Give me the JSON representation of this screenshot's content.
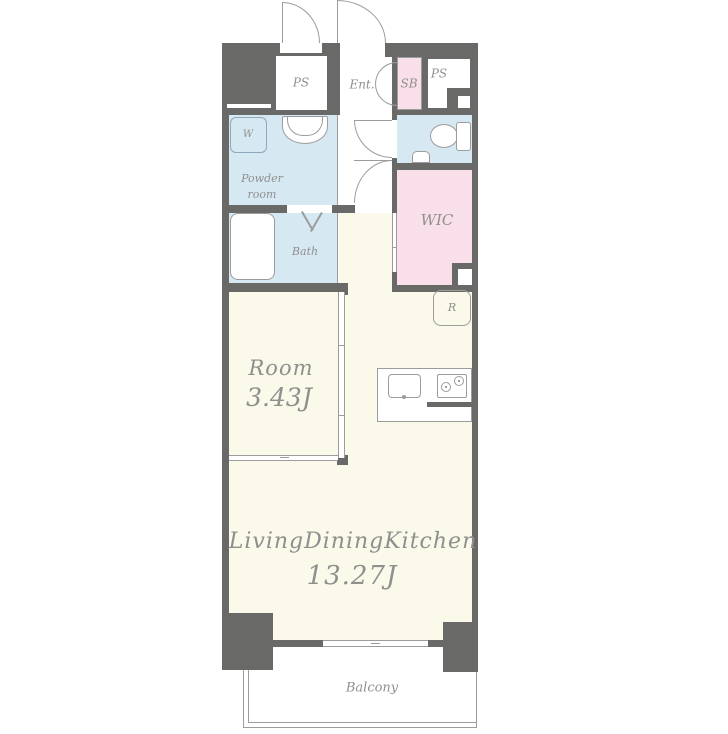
{
  "title": "1LDK apartment floor plan",
  "rooms": {
    "ps_left": {
      "label": "PS"
    },
    "entrance": {
      "label": "Ent."
    },
    "shoe_box": {
      "label": "SB"
    },
    "ps_right": {
      "label": "PS"
    },
    "washer": {
      "label": "W"
    },
    "powder_room": {
      "line1": "Powder",
      "line2": "room"
    },
    "bath": {
      "label": "Bath"
    },
    "wic": {
      "label": "WIC"
    },
    "refrigerator": {
      "label": "R"
    },
    "bedroom": {
      "label": "Room",
      "area": "3.43J"
    },
    "ldk": {
      "label": "LivingDiningKitchen",
      "area": "13.27J"
    },
    "balcony": {
      "label": "Balcony"
    }
  },
  "colors": {
    "wall": "#696967",
    "water_blue": "#d6e8f2",
    "closet_pink": "#f9dfe9",
    "floor_cream": "#fbf9e9",
    "line": "#9c9c9c",
    "text": "#8f8f8e"
  }
}
